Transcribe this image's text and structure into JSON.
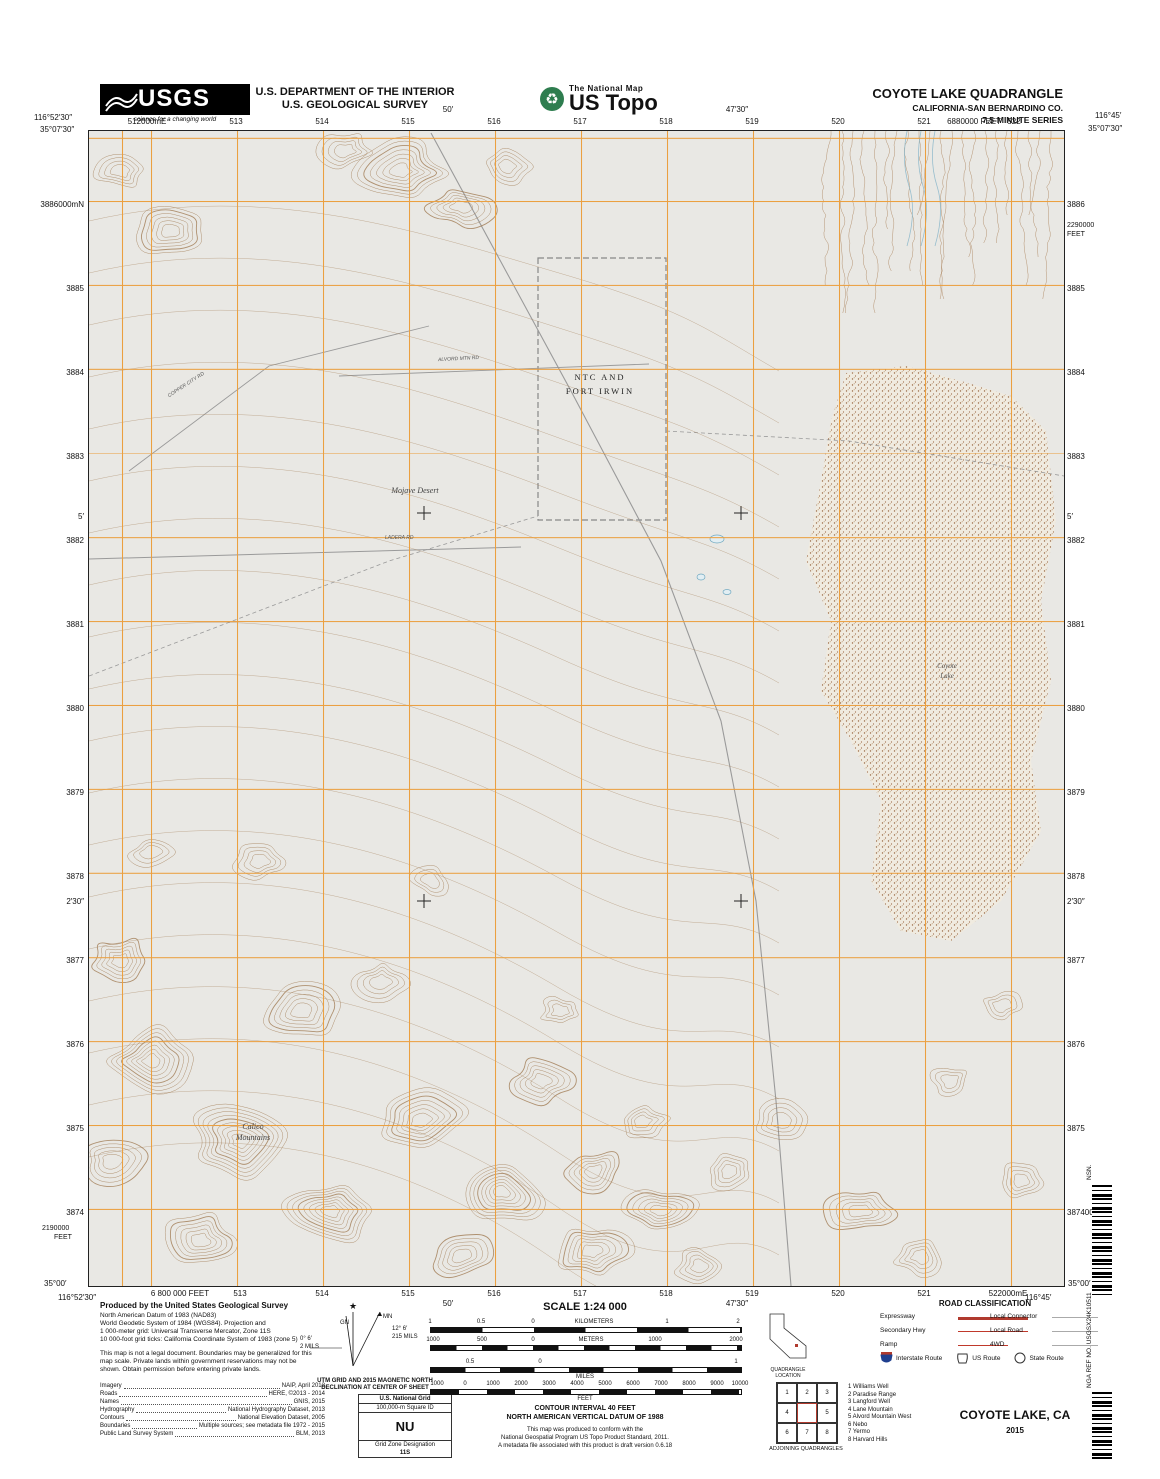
{
  "header": {
    "usgs_logo": "USGS",
    "usgs_tagline": "science for a changing world",
    "dept_line1": "U.S. DEPARTMENT OF THE INTERIOR",
    "dept_line2": "U.S. GEOLOGICAL SURVEY",
    "natmap": "The National Map",
    "ustopo": "US Topo",
    "quad_title": "COYOTE LAKE QUADRANGLE",
    "quad_subtitle": "CALIFORNIA-SAN BERNARDINO CO.",
    "quad_series": "7.5-MINUTE SERIES"
  },
  "map": {
    "corners": {
      "tl_lon": "116°52′30″",
      "tl_lat": "35°07′30″",
      "tr_lon": "116°45′",
      "tr_lat": "35°07′30″",
      "bl_lat": "35°00′",
      "bl_lon": "116°52′30″",
      "br_lat": "35°00′",
      "br_lon": "116°45′"
    },
    "top_nums": [
      {
        "t": "512000mE",
        "x": 147
      },
      {
        "t": "513",
        "x": 236
      },
      {
        "t": "514",
        "x": 322
      },
      {
        "t": "515",
        "x": 408
      },
      {
        "t": "516",
        "x": 494
      },
      {
        "t": "517",
        "x": 580
      },
      {
        "t": "518",
        "x": 666
      },
      {
        "t": "519",
        "x": 752
      },
      {
        "t": "520",
        "x": 838
      },
      {
        "t": "521",
        "x": 924
      },
      {
        "t": "6880000 FEET",
        "x": 974
      },
      {
        "t": "522",
        "x": 1014
      }
    ],
    "top_ticks": [
      {
        "t": "50′",
        "x": 448
      },
      {
        "t": "47′30″",
        "x": 737
      }
    ],
    "bottom_nums": [
      {
        "t": "6 800 000 FEET",
        "x": 180
      },
      {
        "t": "513",
        "x": 240
      },
      {
        "t": "514",
        "x": 322
      },
      {
        "t": "515",
        "x": 408
      },
      {
        "t": "516",
        "x": 494
      },
      {
        "t": "517",
        "x": 580
      },
      {
        "t": "518",
        "x": 666
      },
      {
        "t": "519",
        "x": 752
      },
      {
        "t": "520",
        "x": 838
      },
      {
        "t": "521",
        "x": 924
      },
      {
        "t": "522000mE",
        "x": 1008
      }
    ],
    "bottom_ticks": [
      {
        "t": "50′",
        "x": 448
      },
      {
        "t": "47′30″",
        "x": 737
      }
    ],
    "left_nums": [
      {
        "t": "3886000mN",
        "y": 200
      },
      {
        "t": "3885",
        "y": 284
      },
      {
        "t": "3884",
        "y": 368
      },
      {
        "t": "3883",
        "y": 452
      },
      {
        "t": "3882",
        "y": 536
      },
      {
        "t": "3881",
        "y": 620
      },
      {
        "t": "3880",
        "y": 704
      },
      {
        "t": "3879",
        "y": 788
      },
      {
        "t": "3878",
        "y": 872
      },
      {
        "t": "3877",
        "y": 956
      },
      {
        "t": "3876",
        "y": 1040
      },
      {
        "t": "3875",
        "y": 1124
      },
      {
        "t": "3874",
        "y": 1208
      }
    ],
    "left_ticks": [
      {
        "t": "5′",
        "y": 512
      },
      {
        "t": "2′30″",
        "y": 897
      }
    ],
    "right_nums": [
      {
        "t": "3886",
        "y": 200
      },
      {
        "t": "3885",
        "y": 284
      },
      {
        "t": "3884",
        "y": 368
      },
      {
        "t": "3883",
        "y": 452
      },
      {
        "t": "3882",
        "y": 536
      },
      {
        "t": "3881",
        "y": 620
      },
      {
        "t": "3880",
        "y": 704
      },
      {
        "t": "3879",
        "y": 788
      },
      {
        "t": "3878",
        "y": 872
      },
      {
        "t": "3877",
        "y": 956
      },
      {
        "t": "3876",
        "y": 1040
      },
      {
        "t": "3875",
        "y": 1124
      },
      {
        "t": "3874000mN",
        "y": 1208
      }
    ],
    "right_ticks": [
      {
        "t": "5′",
        "y": 512
      },
      {
        "t": "2′30″",
        "y": 897
      }
    ],
    "feet_right_top_1": "2290000",
    "feet_right_top_2": "FEET",
    "feet_left_bottom_1": "2190000",
    "feet_left_bottom_2": "FEET",
    "labels": {
      "ntc_1": "NTC AND",
      "ntc_2": "FORT IRWIN",
      "mojave": "Mojave Desert",
      "coyote_1": "Coyote",
      "coyote_2": "Lake",
      "calico_1": "Calico",
      "calico_2": "Mountains",
      "road_1": "COPPER CITY RD",
      "road_2": "ALVORD MTN RD",
      "road_3": "LADERA RD"
    }
  },
  "footer": {
    "produced_title": "Produced by the United States Geological Survey",
    "produced_lines": [
      "North American Datum of 1983 (NAD83)",
      "World Geodetic System of 1984 (WGS84). Projection and",
      "1 000-meter grid: Universal Transverse Mercator, Zone 11S",
      "10 000-foot grid ticks: California Coordinate System of 1983 (zone 5)"
    ],
    "legal": "This map is not a legal document. Boundaries may be generalized for this map scale. Private lands within government reservations may not be shown. Obtain permission before entering private lands.",
    "credits": [
      {
        "label": "Imagery",
        "value": "NAIP, April 2012"
      },
      {
        "label": "Roads",
        "value": "HERE, ©2013 - 2014"
      },
      {
        "label": "Names",
        "value": "GNIS, 2015"
      },
      {
        "label": "Hydrography",
        "value": "National Hydrography Dataset, 2013"
      },
      {
        "label": "Contours",
        "value": "National Elevation Dataset, 2005"
      },
      {
        "label": "Boundaries",
        "value": "Multiple sources; see metadata file 1972 - 2015"
      },
      {
        "label": "Public Land Survey System",
        "value": "BLM, 2013"
      }
    ],
    "declination": {
      "caption_1": "UTM GRID AND 2015 MAGNETIC NORTH",
      "caption_2": "DECLINATION AT CENTER OF SHEET",
      "gn": "GN",
      "mn": "MN",
      "gn_deg": "0° 6′",
      "gn_mils": "2 MILS",
      "mn_deg": "12° 6′",
      "mn_mils": "215 MILS"
    },
    "usng": {
      "title": "U.S. National Grid",
      "square_id_label": "100,000-m Square ID",
      "square_id": "NU",
      "zone_label": "Grid Zone Designation",
      "zone": "11S"
    },
    "scale": {
      "title": "SCALE 1:24 000",
      "km": [
        {
          "t": "1",
          "x": 430
        },
        {
          "t": "0.5",
          "x": 481
        },
        {
          "t": "0",
          "x": 533
        },
        {
          "t": "KILOMETERS",
          "x": 594
        },
        {
          "t": "1",
          "x": 667
        },
        {
          "t": "2",
          "x": 738
        }
      ],
      "m": [
        {
          "t": "1000",
          "x": 433
        },
        {
          "t": "500",
          "x": 482
        },
        {
          "t": "0",
          "x": 533
        },
        {
          "t": "METERS",
          "x": 591
        },
        {
          "t": "1000",
          "x": 655
        },
        {
          "t": "2000",
          "x": 736
        }
      ],
      "mi": [
        {
          "t": "0.5",
          "x": 470
        },
        {
          "t": "0",
          "x": 540
        },
        {
          "t": "1",
          "x": 736
        }
      ],
      "mi_word": "MILES",
      "ft": [
        {
          "t": "1000",
          "x": 437
        },
        {
          "t": "0",
          "x": 465
        },
        {
          "t": "1000",
          "x": 493
        },
        {
          "t": "2000",
          "x": 521
        },
        {
          "t": "3000",
          "x": 549
        },
        {
          "t": "4000",
          "x": 577
        },
        {
          "t": "5000",
          "x": 605
        },
        {
          "t": "6000",
          "x": 633
        },
        {
          "t": "7000",
          "x": 661
        },
        {
          "t": "8000",
          "x": 689
        },
        {
          "t": "9000",
          "x": 717
        },
        {
          "t": "10000",
          "x": 740
        }
      ],
      "ft_word": "FEET"
    },
    "contour_note_1": "CONTOUR INTERVAL 40 FEET",
    "contour_note_2": "NORTH AMERICAN VERTICAL DATUM OF 1988",
    "std_lines": [
      "This map was produced to conform with the",
      "National Geospatial Program US Topo Product Standard, 2011.",
      "A metadata file associated with this product is draft version 0.6.18"
    ],
    "ca_caption": "QUADRANGLE LOCATION",
    "road_class": {
      "title": "ROAD CLASSIFICATION",
      "expressway": "Expressway",
      "secondary": "Secondary Hwy",
      "ramp": "Ramp",
      "local_connector": "Local Connector",
      "local_road": "Local Road",
      "fourwd": "4WD",
      "interstate": "Interstate Route",
      "us_route": "US Route",
      "state_route": "State Route",
      "red": "#b03a2e",
      "gray": "#aaaaaa",
      "shield_blue": "#1f3f8f"
    },
    "adjoining": {
      "caption": "ADJOINING QUADRANGLES",
      "cells": [
        "1",
        "2",
        "3",
        "4",
        "",
        "5",
        "6",
        "7",
        "8"
      ],
      "list": [
        "1 Williams Well",
        "2 Paradise Range",
        "3 Langford Well",
        "4 Lane Mountain",
        "5 Alvord Mountain West",
        "6 Nebo",
        "7 Yermo",
        "8 Harvard Hills"
      ]
    },
    "map_name": "COYOTE LAKE, CA",
    "year": "2015",
    "nsn": "NSN.",
    "nga_ref": "NGA REF NO. USGSX24K10511"
  }
}
